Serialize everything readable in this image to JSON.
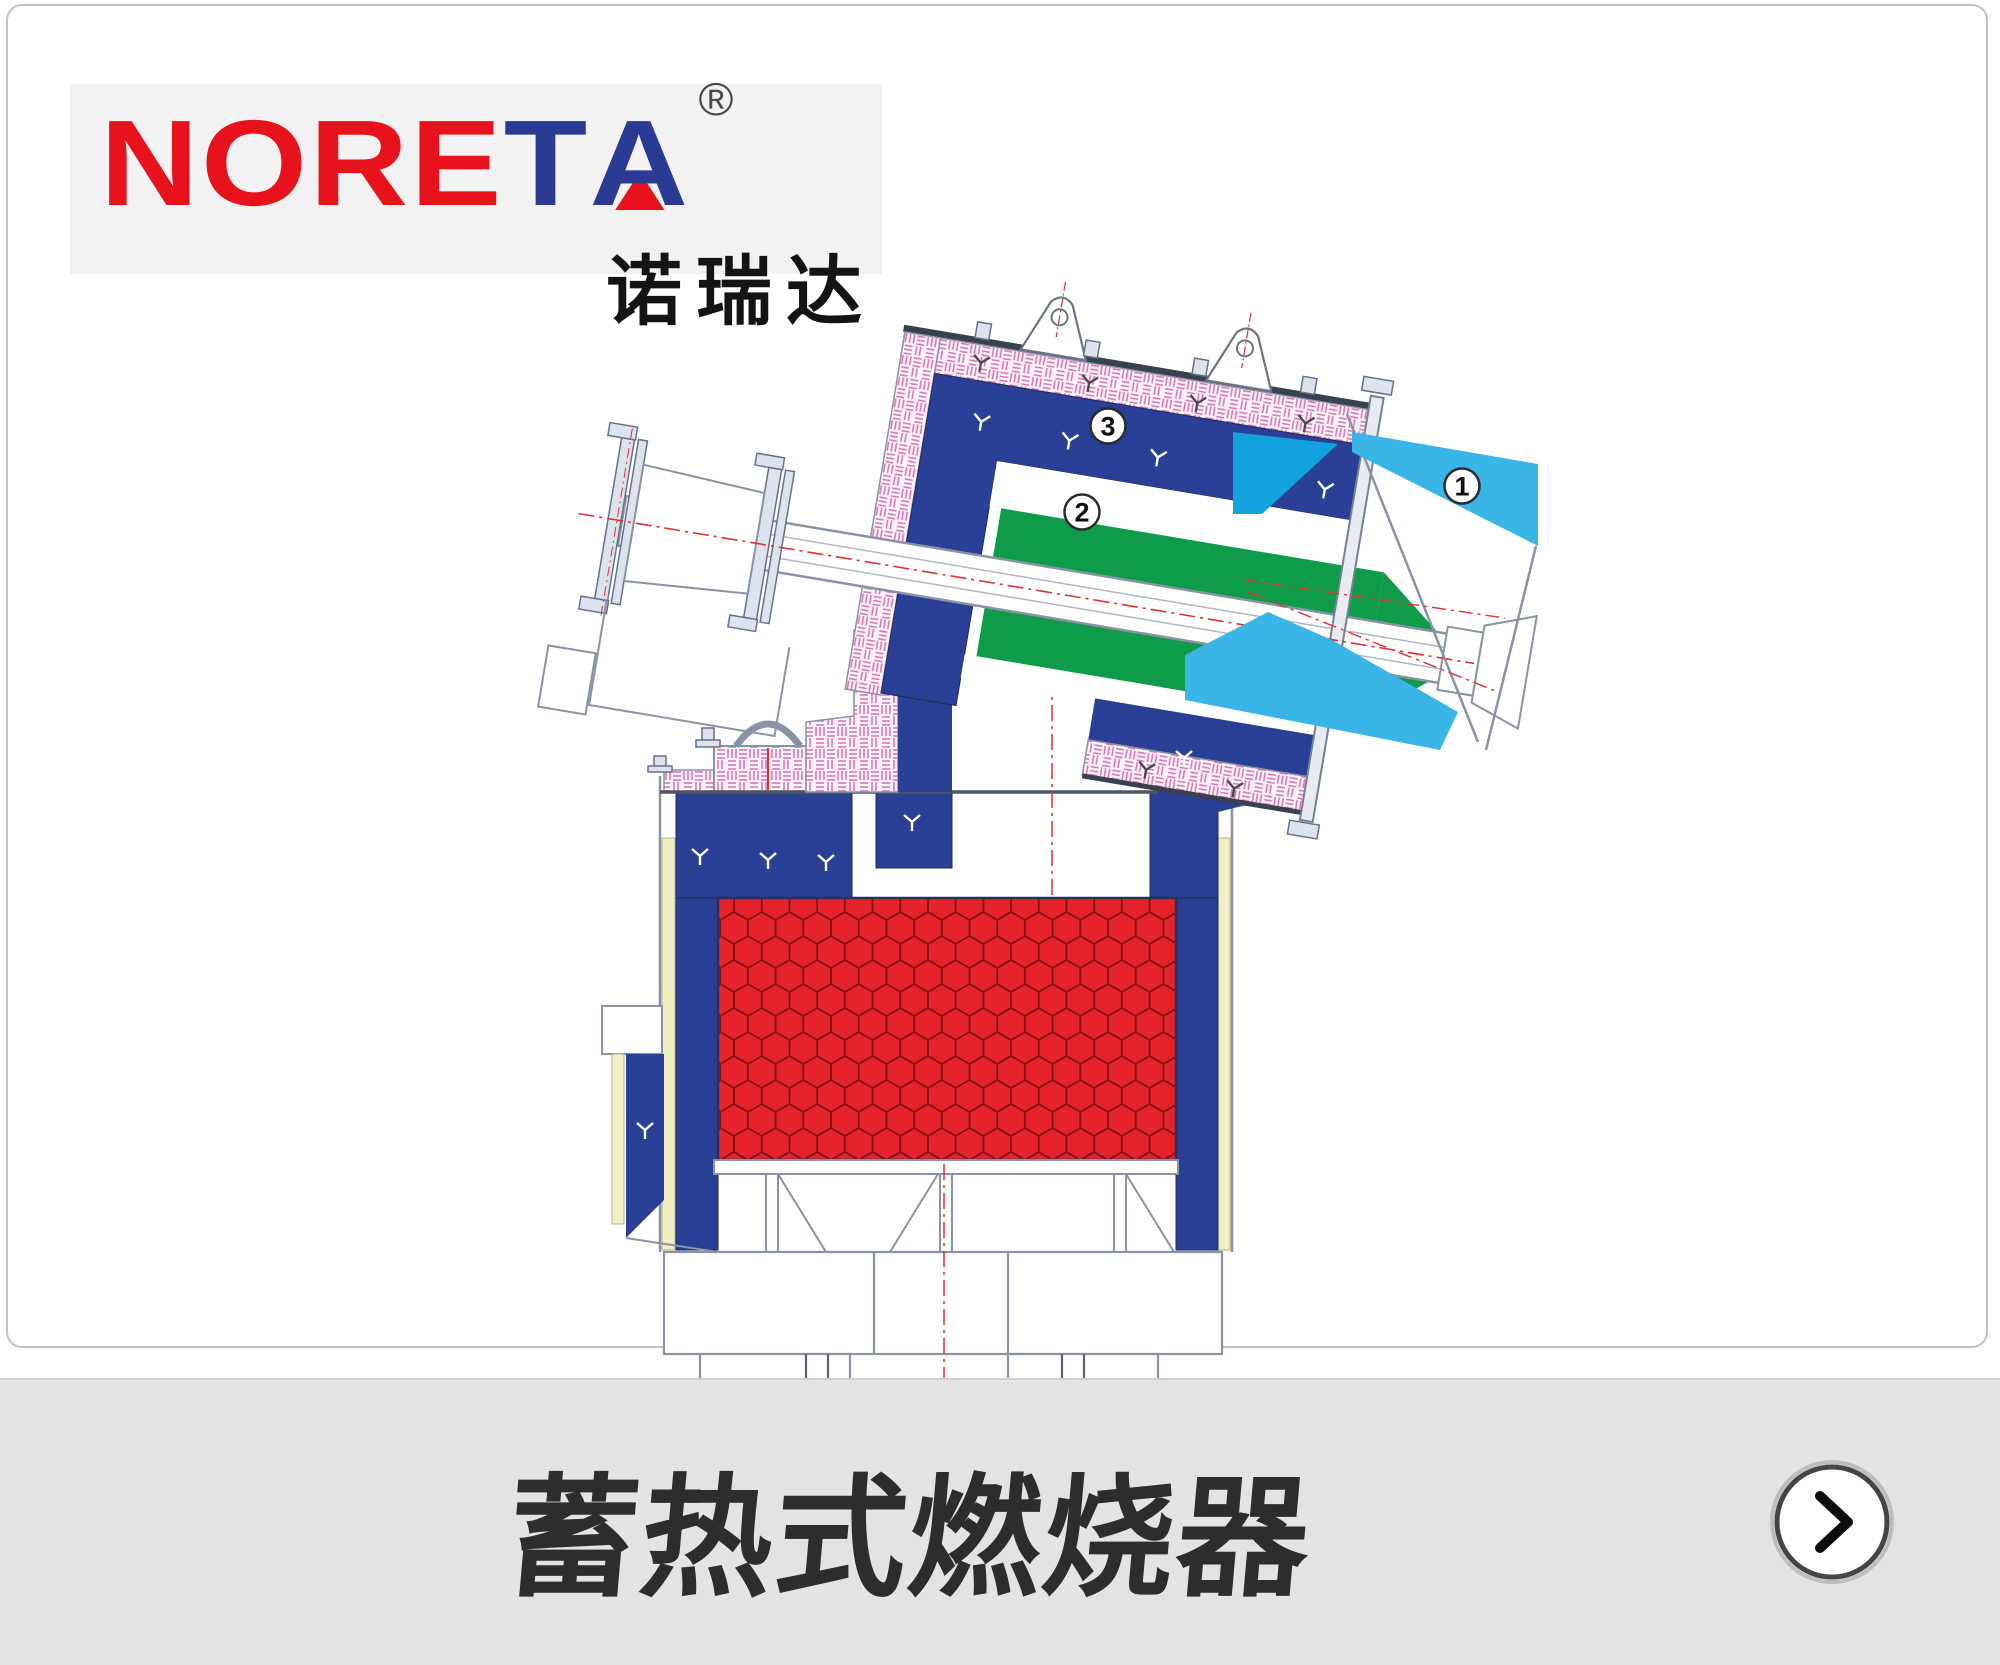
{
  "brand": {
    "wordmark_left": "NORE",
    "wordmark_t": "T",
    "wordmark_a": "A",
    "registered_mark": "®",
    "chinese_name": "诺瑞达"
  },
  "diagram": {
    "callouts": [
      {
        "number": "1"
      },
      {
        "number": "2"
      },
      {
        "number": "3"
      }
    ],
    "colors": {
      "navy": "#2a3f96",
      "green": "#0f9c4a",
      "cyan": "#3ab5e8",
      "cyan_dark": "#12a3de",
      "red": "#e6222b",
      "hatch_pink": "#d66fb0",
      "insulation_yellow": "#f2efc4",
      "centerline_red": "#e03131",
      "outline_gray": "#8a93a5"
    }
  },
  "footer": {
    "title": "蓄热式燃烧器"
  }
}
